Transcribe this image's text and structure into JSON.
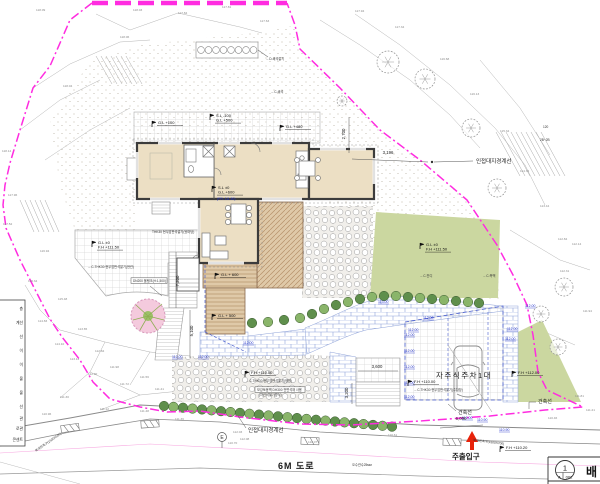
{
  "colors": {
    "boundary": "#ff2ce0",
    "lawn": "#cbd7a0",
    "hedge_dark": "#5f8f4c",
    "hedge_light": "#8ab56a",
    "deck": "#dfc9a8",
    "house_fill": "#ecdfc4",
    "wall": "#3c3c3c",
    "brick_line": "#8fa3d9",
    "blue_tag": "#2433cc",
    "red_arrow": "#e8220a",
    "pink_tree": "#f4cadd"
  },
  "labels": {
    "boundary_right": "인접대지경계선",
    "boundary_bottom": "인접대지경계선",
    "building_line_left": "건축선",
    "building_line_right": "건축선",
    "parking": "자주식주차1대",
    "road": "6M 도로",
    "entrance": "주출입구",
    "pole": "E",
    "sheet_no": "1",
    "sheet_col_a": "A",
    "sheet_col_b": "002",
    "sheet_title": "배"
  },
  "markers": [
    {
      "x": 152,
      "y": 124,
      "lines": [
        "G.L +100"
      ]
    },
    {
      "x": 210,
      "y": 117,
      "lines": [
        "S.L -100",
        "G.L +500"
      ]
    },
    {
      "x": 280,
      "y": 128,
      "lines": [
        "G.L +480"
      ]
    },
    {
      "x": 212,
      "y": 189,
      "lines": [
        "S.L ±0",
        "G.L +600"
      ],
      "sub": "(FFL 111.50)"
    },
    {
      "x": 92,
      "y": 244,
      "lines": [
        "G.L ±0",
        "F.H +111.50"
      ]
    },
    {
      "x": 215,
      "y": 276,
      "lines": [
        "G.L + 600"
      ]
    },
    {
      "x": 212,
      "y": 317,
      "lines": [
        "G.L + 500"
      ]
    },
    {
      "x": 420,
      "y": 246,
      "lines": [
        "G.L ±0",
        "F.H +111.50"
      ]
    },
    {
      "x": 245,
      "y": 374,
      "lines": [
        "F.H +110.50"
      ]
    },
    {
      "x": 408,
      "y": 383,
      "lines": [
        "F.H +110.00"
      ]
    },
    {
      "x": 512,
      "y": 374,
      "lines": [
        "F.H +112.00"
      ]
    },
    {
      "x": 500,
      "y": 449,
      "lines": [
        "F.H +110.20"
      ]
    }
  ],
  "dims": [
    {
      "x": 388,
      "y": 154,
      "t": "3,196"
    },
    {
      "x": 345,
      "y": 134,
      "t": "2,700",
      "rot": -90
    },
    {
      "x": 179,
      "y": 281,
      "t": "7,200",
      "rot": -90
    },
    {
      "x": 193,
      "y": 331,
      "t": "5,100",
      "rot": -90
    },
    {
      "x": 377,
      "y": 368,
      "t": "3,600"
    },
    {
      "x": 348,
      "y": 393,
      "t": "3,200",
      "rot": -90
    },
    {
      "x": 461,
      "y": 420,
      "t": "6,000"
    }
  ],
  "notes": [
    {
      "x": 152,
      "y": 233,
      "t": "THK30 현무암판석깔기(뒷마당)"
    },
    {
      "x": 88,
      "y": 268,
      "t": "←C-THK30 현무암판석깔기(현관)"
    },
    {
      "x": 133,
      "y": 282,
      "t": "DN200 물탱크(H:1,500)",
      "boxed": true,
      "w": 36
    },
    {
      "x": 257,
      "y": 391,
      "t": "보강토옹벽 DH300 전면석재 사용",
      "boxed": true,
      "w": 50
    },
    {
      "x": 259,
      "y": 396,
      "t": "(자연석쌓기방식)"
    },
    {
      "x": 246,
      "y": 382,
      "t": "←C-THK30 현무암판석깔기(정원)"
    },
    {
      "x": 414,
      "y": 391,
      "t": "←C-THK30 현무암판석깔기(주차장)"
    },
    {
      "x": 420,
      "y": 277,
      "t": "←C-잔디"
    },
    {
      "x": 483,
      "y": 277,
      "t": "←C-측백"
    },
    {
      "x": 271,
      "y": 93,
      "t": "←C-쇄석"
    },
    {
      "x": 266,
      "y": 60,
      "t": "←D-쇄석깔기"
    },
    {
      "x": 473,
      "y": 441,
      "t": "복개된측구(1500X700)",
      "rot": 7
    },
    {
      "x": 36,
      "y": 452,
      "t": "복개된측구(1500X500)",
      "rot": -35
    },
    {
      "x": 352,
      "y": 466,
      "t": "오수관수25мм"
    },
    {
      "x": 543,
      "y": 128,
      "t": "120"
    },
    {
      "x": 540,
      "y": 141,
      "t": "2B~2B"
    }
  ],
  "spots": [
    {
      "x": 36,
      "y": 11,
      "t": "118.09"
    },
    {
      "x": 133,
      "y": 11,
      "t": "118.03"
    },
    {
      "x": 178,
      "y": 14,
      "t": "117.84"
    },
    {
      "x": 222,
      "y": 8,
      "t": "117.81"
    },
    {
      "x": 260,
      "y": 22,
      "t": "117.63"
    },
    {
      "x": 120,
      "y": 38,
      "t": "118.06"
    },
    {
      "x": 63,
      "y": 87,
      "t": "118.04"
    },
    {
      "x": 2,
      "y": 152,
      "t": "118.14"
    },
    {
      "x": 8,
      "y": 196,
      "t": "117.96"
    },
    {
      "x": 3,
      "y": 225,
      "t": "117.52"
    },
    {
      "x": 40,
      "y": 252,
      "t": "116.94"
    },
    {
      "x": 28,
      "y": 282,
      "t": "116.34"
    },
    {
      "x": 58,
      "y": 300,
      "t": "115.48"
    },
    {
      "x": 38,
      "y": 322,
      "t": "114.83"
    },
    {
      "x": 55,
      "y": 345,
      "t": "114.10"
    },
    {
      "x": 78,
      "y": 330,
      "t": "113.65"
    },
    {
      "x": 70,
      "y": 360,
      "t": "113.12"
    },
    {
      "x": 95,
      "y": 352,
      "t": "112.84"
    },
    {
      "x": 88,
      "y": 375,
      "t": "112.30"
    },
    {
      "x": 110,
      "y": 368,
      "t": "111.98"
    },
    {
      "x": 120,
      "y": 385,
      "t": "111.72"
    },
    {
      "x": 140,
      "y": 378,
      "t": "111.56"
    },
    {
      "x": 155,
      "y": 390,
      "t": "111.41"
    },
    {
      "x": 60,
      "y": 398,
      "t": "111.30"
    },
    {
      "x": 100,
      "y": 410,
      "t": "111.12"
    },
    {
      "x": 42,
      "y": 415,
      "t": "110.96"
    },
    {
      "x": 140,
      "y": 412,
      "t": "111.48"
    },
    {
      "x": 175,
      "y": 420,
      "t": "111.36"
    },
    {
      "x": 228,
      "y": 444,
      "t": "110.70"
    },
    {
      "x": 308,
      "y": 443,
      "t": "110.07"
    },
    {
      "x": 388,
      "y": 436,
      "t": "110.61"
    },
    {
      "x": 233,
      "y": 433,
      "t": "112.03"
    },
    {
      "x": 240,
      "y": 440,
      "t": "112.08"
    },
    {
      "x": 355,
      "y": 12,
      "t": "117.94"
    },
    {
      "x": 395,
      "y": 28,
      "t": "117.34"
    },
    {
      "x": 440,
      "y": 60,
      "t": "116.68"
    },
    {
      "x": 470,
      "y": 95,
      "t": "116.13"
    },
    {
      "x": 500,
      "y": 132,
      "t": "115.34"
    },
    {
      "x": 520,
      "y": 172,
      "t": "114.32"
    },
    {
      "x": 540,
      "y": 207,
      "t": "113.44"
    },
    {
      "x": 558,
      "y": 240,
      "t": "112.84"
    },
    {
      "x": 572,
      "y": 245,
      "t": "112.14"
    },
    {
      "x": 560,
      "y": 272,
      "t": "112.31"
    },
    {
      "x": 583,
      "y": 312,
      "t": "111.94"
    },
    {
      "x": 575,
      "y": 397,
      "t": "111.81"
    },
    {
      "x": 586,
      "y": 411,
      "t": "111.21"
    },
    {
      "x": 548,
      "y": 419,
      "t": "110.46"
    }
  ],
  "blue_tags": [
    {
      "x": 243,
      "y": 344,
      "t": "112.00"
    },
    {
      "x": 198,
      "y": 358,
      "t": "112.00"
    },
    {
      "x": 172,
      "y": 358,
      "t": "112.00"
    },
    {
      "x": 378,
      "y": 303,
      "t": "113.00"
    },
    {
      "x": 408,
      "y": 331,
      "t": "112.00"
    },
    {
      "x": 423,
      "y": 319,
      "t": "112.00"
    },
    {
      "x": 507,
      "y": 330,
      "t": "112.00"
    },
    {
      "x": 505,
      "y": 340,
      "t": "112.00"
    },
    {
      "x": 404,
      "y": 336,
      "t": "112.00"
    },
    {
      "x": 404,
      "y": 352,
      "t": "112.00"
    },
    {
      "x": 404,
      "y": 368,
      "t": "112.00"
    },
    {
      "x": 404,
      "y": 384,
      "t": "112.00"
    },
    {
      "x": 404,
      "y": 398,
      "t": "112.00"
    },
    {
      "x": 462,
      "y": 419,
      "t": "112.00"
    },
    {
      "x": 477,
      "y": 421,
      "t": "110.90"
    },
    {
      "x": 499,
      "y": 431,
      "t": "110.90"
    },
    {
      "x": 525,
      "y": 307,
      "t": "112.00"
    }
  ],
  "legend_rows": [
    {
      "y": 310,
      "t": "층"
    },
    {
      "y": 324,
      "t": "계선"
    },
    {
      "y": 338,
      "t": "선"
    },
    {
      "y": 352,
      "t": "이"
    },
    {
      "y": 366,
      "t": "이"
    },
    {
      "y": 380,
      "t": "물"
    },
    {
      "y": 394,
      "t": "물"
    },
    {
      "y": 408,
      "t": "선"
    },
    {
      "y": 420,
      "t": "관"
    },
    {
      "y": 430,
      "t": "로관"
    },
    {
      "y": 441,
      "t": "콘센트"
    }
  ]
}
